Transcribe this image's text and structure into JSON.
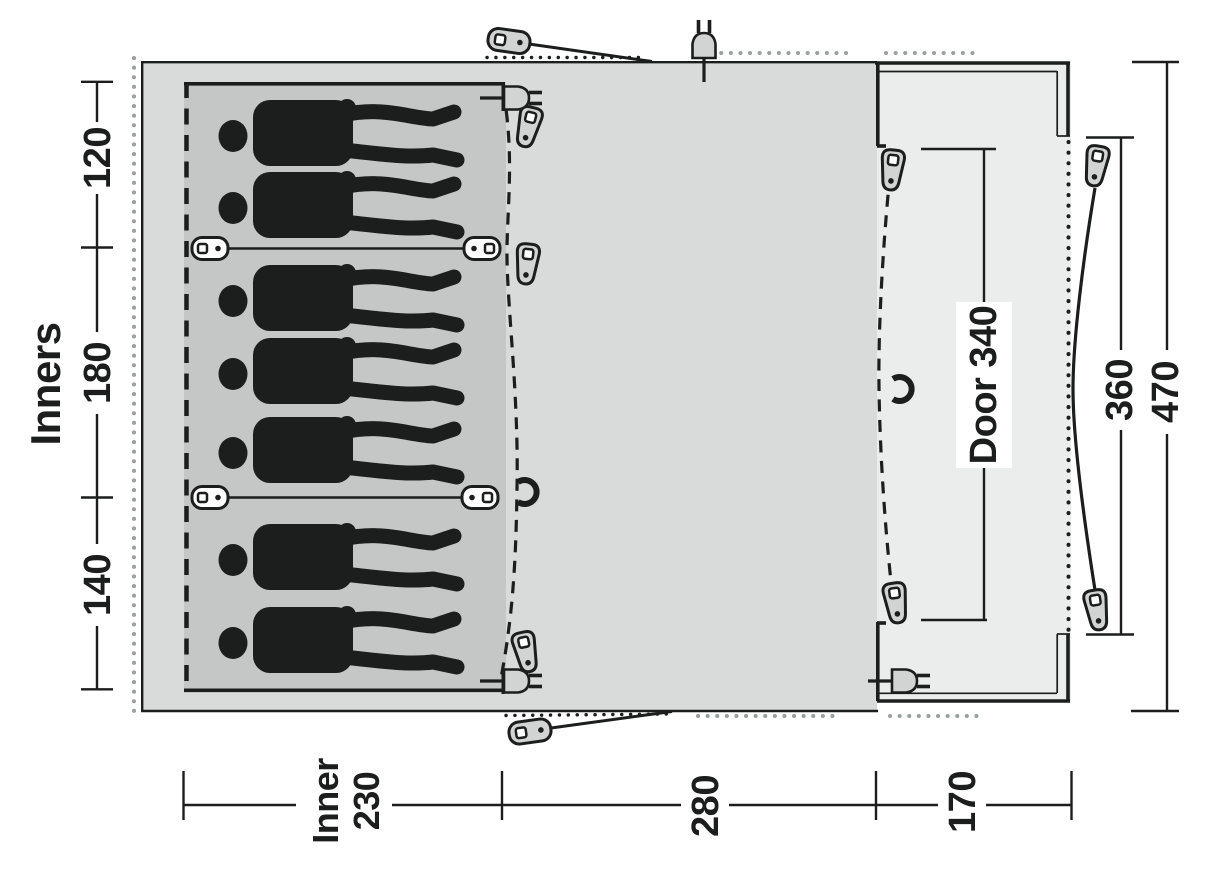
{
  "diagram": {
    "labels": {
      "inners": "Inners",
      "left_sections": [
        "120",
        "180",
        "140"
      ],
      "bottom_inner_line1": "Inner",
      "bottom_inner_line2": "230",
      "bottom_living": "280",
      "bottom_porch": "170",
      "door": "Door 340",
      "right_inner": "360",
      "right_total": "470"
    },
    "sleepers": {
      "count": 7,
      "groups": [
        2,
        3,
        2
      ]
    },
    "colors": {
      "body_fill": "#d9dbda",
      "inner_fill": "#c4c7c6",
      "porch_fill": "#ebedec",
      "ink": "#1c1e1d",
      "dots": "#9aa09e",
      "hardware_fill": "#d2d4d3"
    },
    "icons": [
      "zipper-pull-icon",
      "toggle-clip-icon",
      "power-plug-icon",
      "guyline-toggle-icon",
      "hook-clip-icon"
    ]
  }
}
